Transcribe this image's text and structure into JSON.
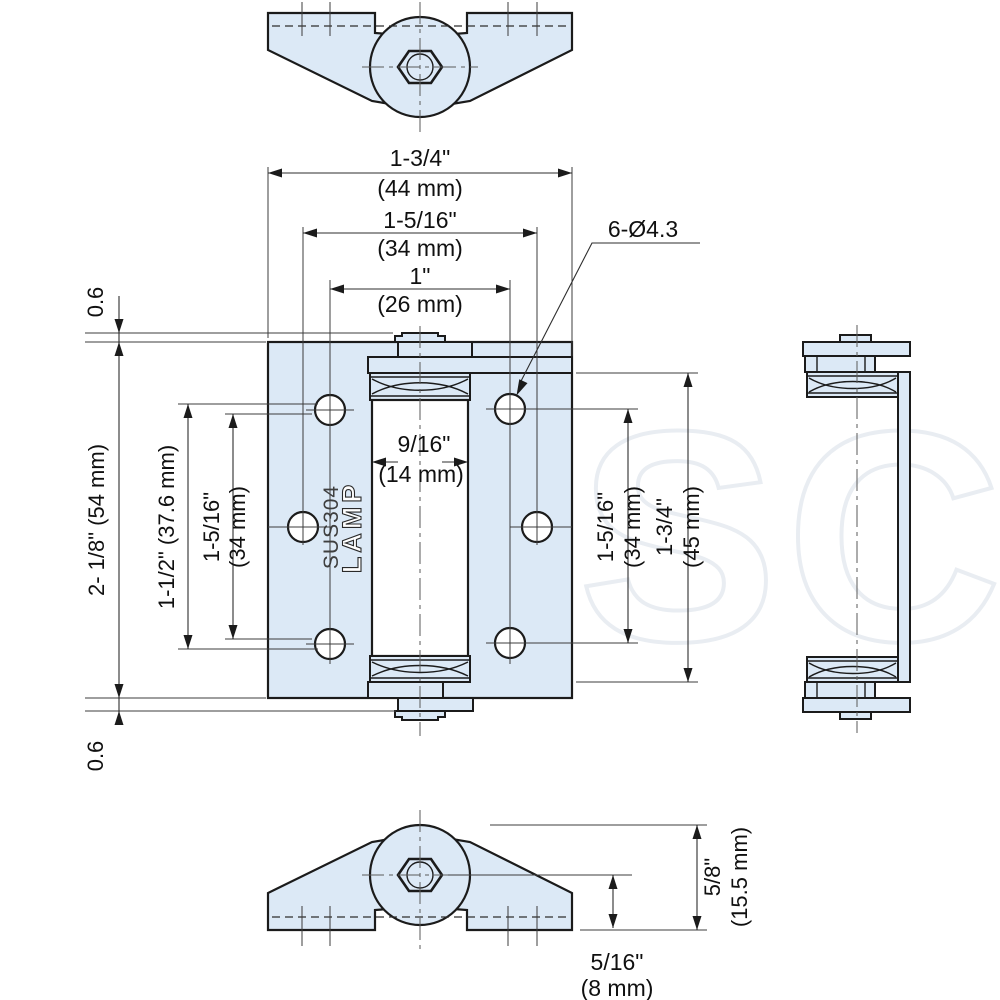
{
  "drawing": {
    "watermark": "MSC",
    "part_markings": {
      "brand": "LAMP",
      "material": "SUS304"
    },
    "hole_callout": "6-Ø4.3",
    "dims": {
      "leaf_width_in": "1-3/4\"",
      "leaf_width_mm": "(44 mm)",
      "hole_span_outer_in": "1-5/16\"",
      "hole_span_outer_mm": "(34 mm)",
      "hole_span_inner_in": "1\"",
      "hole_span_inner_mm": "(26 mm)",
      "edge_offset_top": "0.6",
      "leaf_height": "2- 1/8\" (54 mm)",
      "hole_pitch_left": "1-1/2\" (37.6 mm)",
      "left_span_in": "1-5/16\"",
      "left_span_mm": "(34 mm)",
      "barrel_dia_in": "9/16\"",
      "barrel_dia_mm": "(14 mm)",
      "right_span_in": "1-5/16\"",
      "right_span_mm": "(34 mm)",
      "knuckle_height_in": "1-3/4\"",
      "knuckle_height_mm": "(45 mm)",
      "edge_offset_bottom": "0.6",
      "depth_in": "5/8\"",
      "depth_mm": "(15.5 mm)",
      "pin_offset_in": "5/16\"",
      "pin_offset_mm": "(8 mm)"
    }
  }
}
